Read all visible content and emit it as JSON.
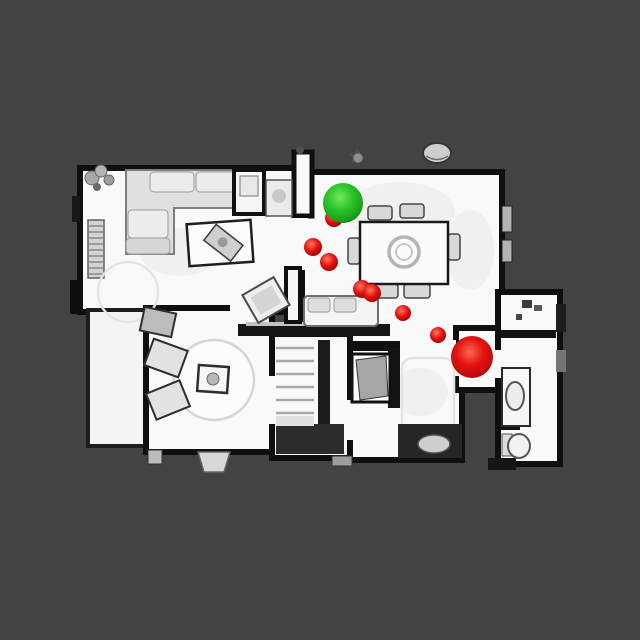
{
  "scene": {
    "background_color": "#434343",
    "floor_color": "#f9f9f9",
    "wall_color": "#0f0f0f"
  },
  "markers": {
    "start": {
      "x": 343,
      "y": 203,
      "radius": 20,
      "color": "#2bc42b"
    },
    "goal": {
      "x": 472,
      "y": 357,
      "radius": 21,
      "color": "#d91111"
    },
    "waypoint_color": "#e51212",
    "waypoints": [
      {
        "x": 334,
        "y": 218,
        "radius": 9
      },
      {
        "x": 313,
        "y": 247,
        "radius": 9
      },
      {
        "x": 329,
        "y": 262,
        "radius": 9
      },
      {
        "x": 362,
        "y": 289,
        "radius": 9
      },
      {
        "x": 372,
        "y": 293,
        "radius": 9
      },
      {
        "x": 403,
        "y": 313,
        "radius": 8
      },
      {
        "x": 438,
        "y": 335,
        "radius": 8
      }
    ]
  }
}
